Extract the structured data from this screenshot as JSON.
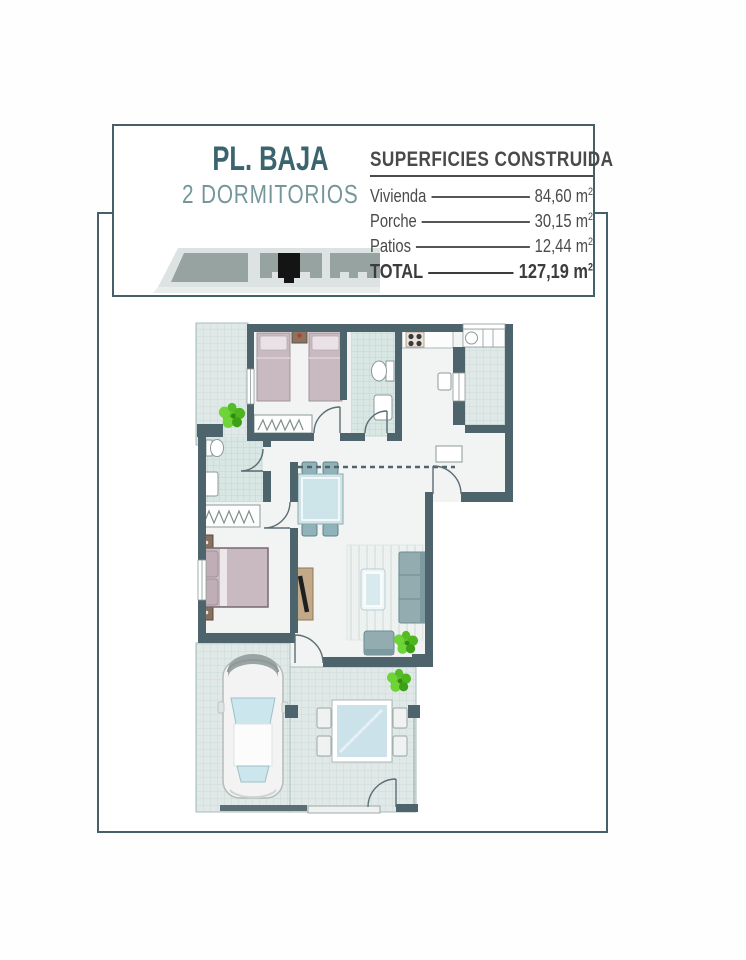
{
  "header": {
    "title": "PL. BAJA",
    "subtitle": "2 DORMITORIOS",
    "thumbnail": "building-row-footprint-with-highlighted-unit"
  },
  "surfaces": {
    "title": "SUPERFICIES CONSTRUIDA",
    "rows": [
      {
        "label": "Vivienda",
        "value": "84,60",
        "unit": "m",
        "sup": "2"
      },
      {
        "label": "Porche",
        "value": "30,15",
        "unit": "m",
        "sup": "2"
      },
      {
        "label": "Patios",
        "value": "12,44",
        "unit": "m",
        "sup": "2"
      },
      {
        "label": "TOTAL",
        "value": "127,19",
        "unit": "m",
        "sup": "2"
      }
    ]
  },
  "floor_plan": {
    "type": "apartment-ground-floor-2-bedrooms",
    "rooms": [
      "patio-top-left",
      "twin-bedroom",
      "bathroom-1",
      "kitchen",
      "utility-patio-right",
      "hallway",
      "bathroom-2",
      "master-bedroom",
      "dining-area",
      "living-room",
      "carport",
      "porch-terrace"
    ],
    "furniture": [
      "two-twin-beds",
      "nightstands",
      "wardrobe-hangers",
      "toilet",
      "washbasin",
      "stove-4-burners",
      "washing-machine",
      "dining-table-4-chairs",
      "tv-sideboard",
      "double-bed",
      "rug",
      "coffee-table",
      "sofa",
      "armchair",
      "potted-plants",
      "car-top-view",
      "outdoor-glass-table-4-chairs"
    ]
  },
  "colors": {
    "frame_border": "#456069",
    "title_teal": "#3B656E",
    "subtitle_teal": "#75979C",
    "table_text": "#4A4A4A",
    "wall": "#4E646C",
    "tile_floor": "#E0E9E7",
    "bath_tile": "#D8E7E4",
    "bed_mauve": "#C9BAC1",
    "furniture_teal": "#92ACB0",
    "plant_green": "#5EC22D",
    "glass_blue": "#CDE4EA"
  }
}
